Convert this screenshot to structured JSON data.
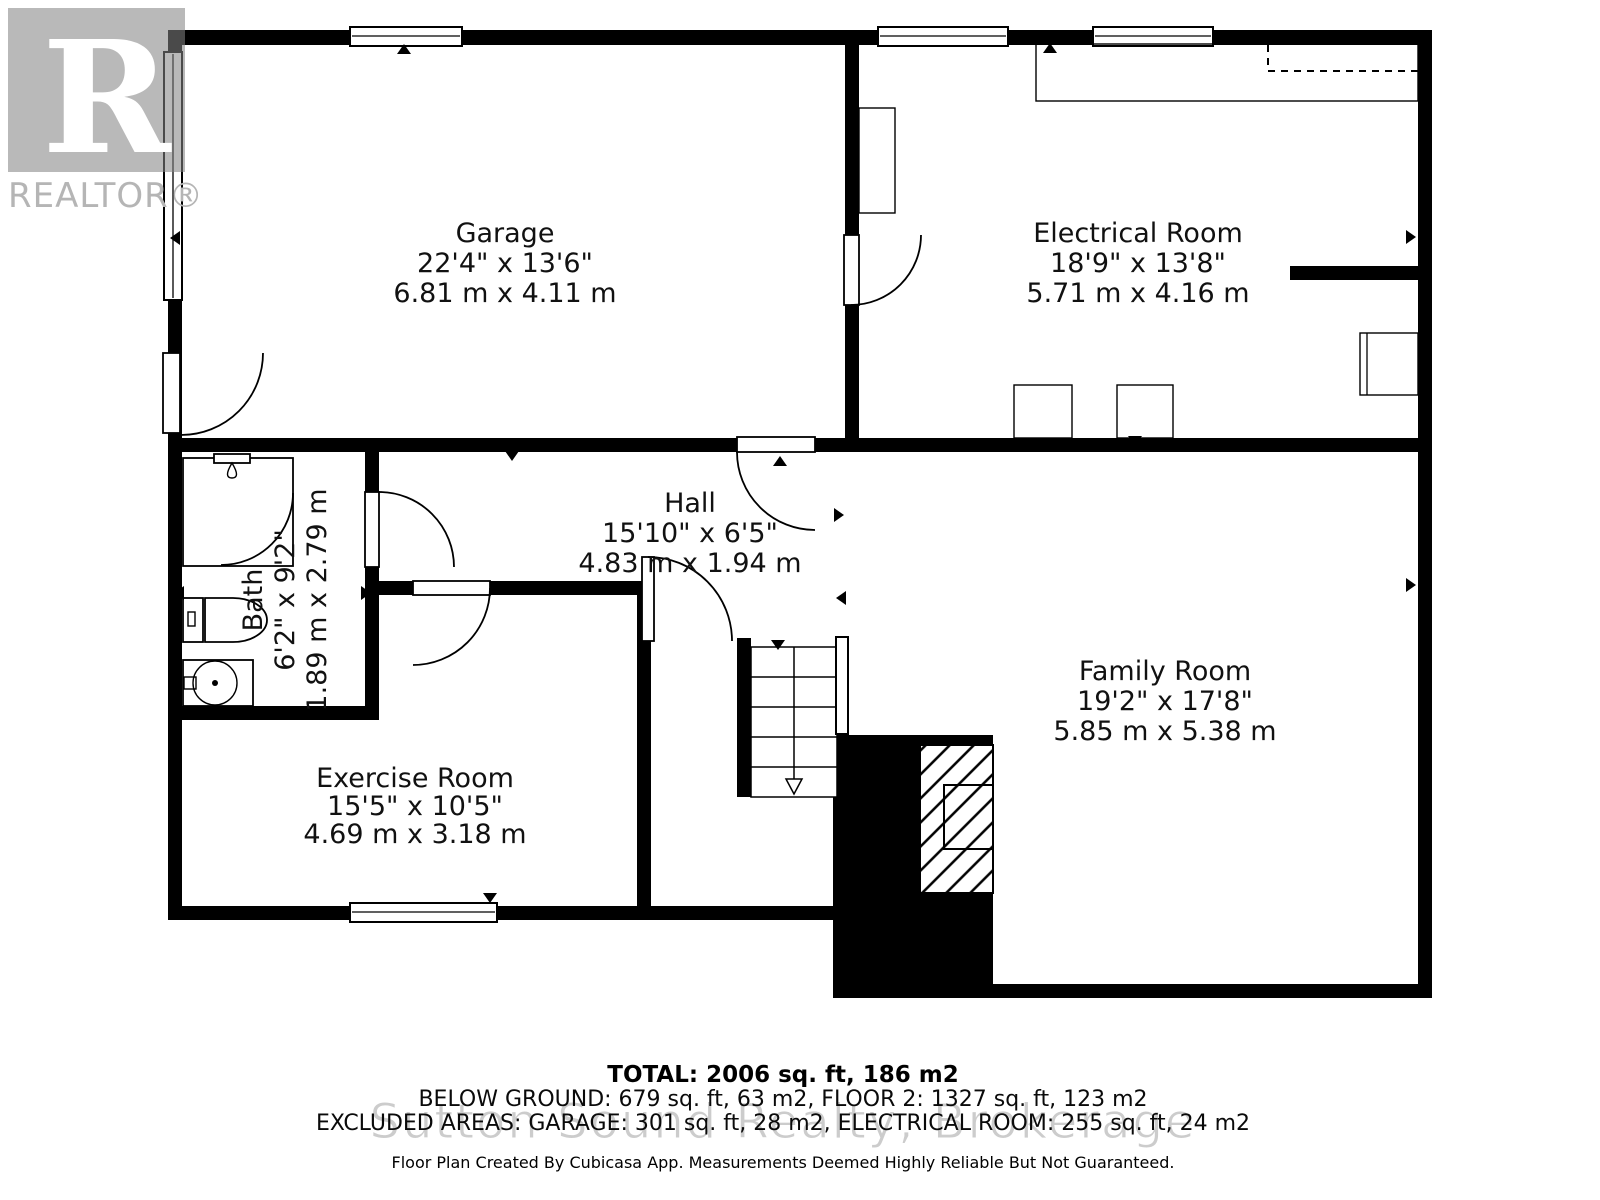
{
  "branding": {
    "logo_letter": "R",
    "logo_text": "REALTOR®"
  },
  "watermark": "Sutton Sound Realty, Brokerage",
  "rooms": {
    "garage": {
      "name": "Garage",
      "imperial": "22'4\" x 13'6\"",
      "metric": "6.81 m x 4.11 m"
    },
    "electrical_room": {
      "name": "Electrical Room",
      "imperial": "18'9\" x 13'8\"",
      "metric": "5.71 m x 4.16 m"
    },
    "hall": {
      "name": "Hall",
      "imperial": "15'10\" x 6'5\"",
      "metric": "4.83 m x 1.94 m"
    },
    "bath": {
      "name": "Bath",
      "imperial": "6'2\" x 9'2\"",
      "metric": "1.89 m x 2.79 m"
    },
    "exercise_room": {
      "name": "Exercise Room",
      "imperial": "15'5\" x 10'5\"",
      "metric": "4.69 m x 3.18 m"
    },
    "family_room": {
      "name": "Family Room",
      "imperial": "19'2\" x 17'8\"",
      "metric": "5.85 m x 5.38 m"
    }
  },
  "summary": {
    "total": "TOTAL: 2006 sq. ft, 186 m2",
    "below_ground": "BELOW GROUND: 679 sq. ft, 63 m2, FLOOR 2: 1327 sq. ft, 123 m2",
    "excluded_areas": "EXCLUDED AREAS: GARAGE: 301 sq. ft, 28 m2, ELECTRICAL ROOM: 255 sq. ft, 24 m2",
    "disclaimer": "Floor Plan Created By Cubicasa App. Measurements Deemed Highly Reliable But Not Guaranteed."
  },
  "colors": {
    "wall": "#000000",
    "logo_gray": "#b5b5b5",
    "watermark_gray": "#cccccc"
  }
}
